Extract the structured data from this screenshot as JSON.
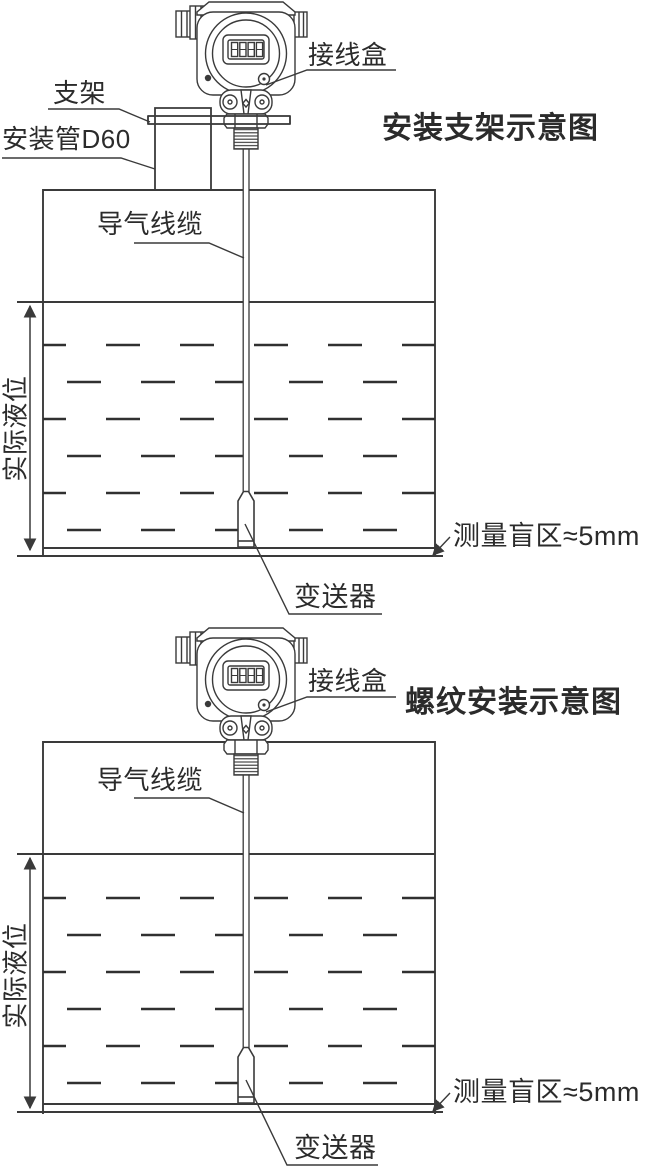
{
  "doc_type": "level-transmitter installation schematic",
  "colors": {
    "background": "#ffffff",
    "line": "#3a3a3a",
    "dash_line": "#303030",
    "text": "#2b2b2b"
  },
  "diagram1": {
    "title": "安装支架示意图",
    "labels": {
      "junction_box": "接线盒",
      "bracket": "支架",
      "mounting_pipe": "安装管D60",
      "air_cable": "导气线缆",
      "actual_level": "实际液位",
      "blind_zone": "测量盲区≈5mm",
      "transmitter": "变送器"
    }
  },
  "diagram2": {
    "title": "螺纹安装示意图",
    "labels": {
      "junction_box": "接线盒",
      "air_cable": "导气线缆",
      "actual_level": "实际液位",
      "blind_zone": "测量盲区≈5mm",
      "transmitter": "变送器"
    }
  },
  "icons": {
    "lcd_display": "lcd-display-icon",
    "dimension_arrow": "double-headed-arrow"
  }
}
